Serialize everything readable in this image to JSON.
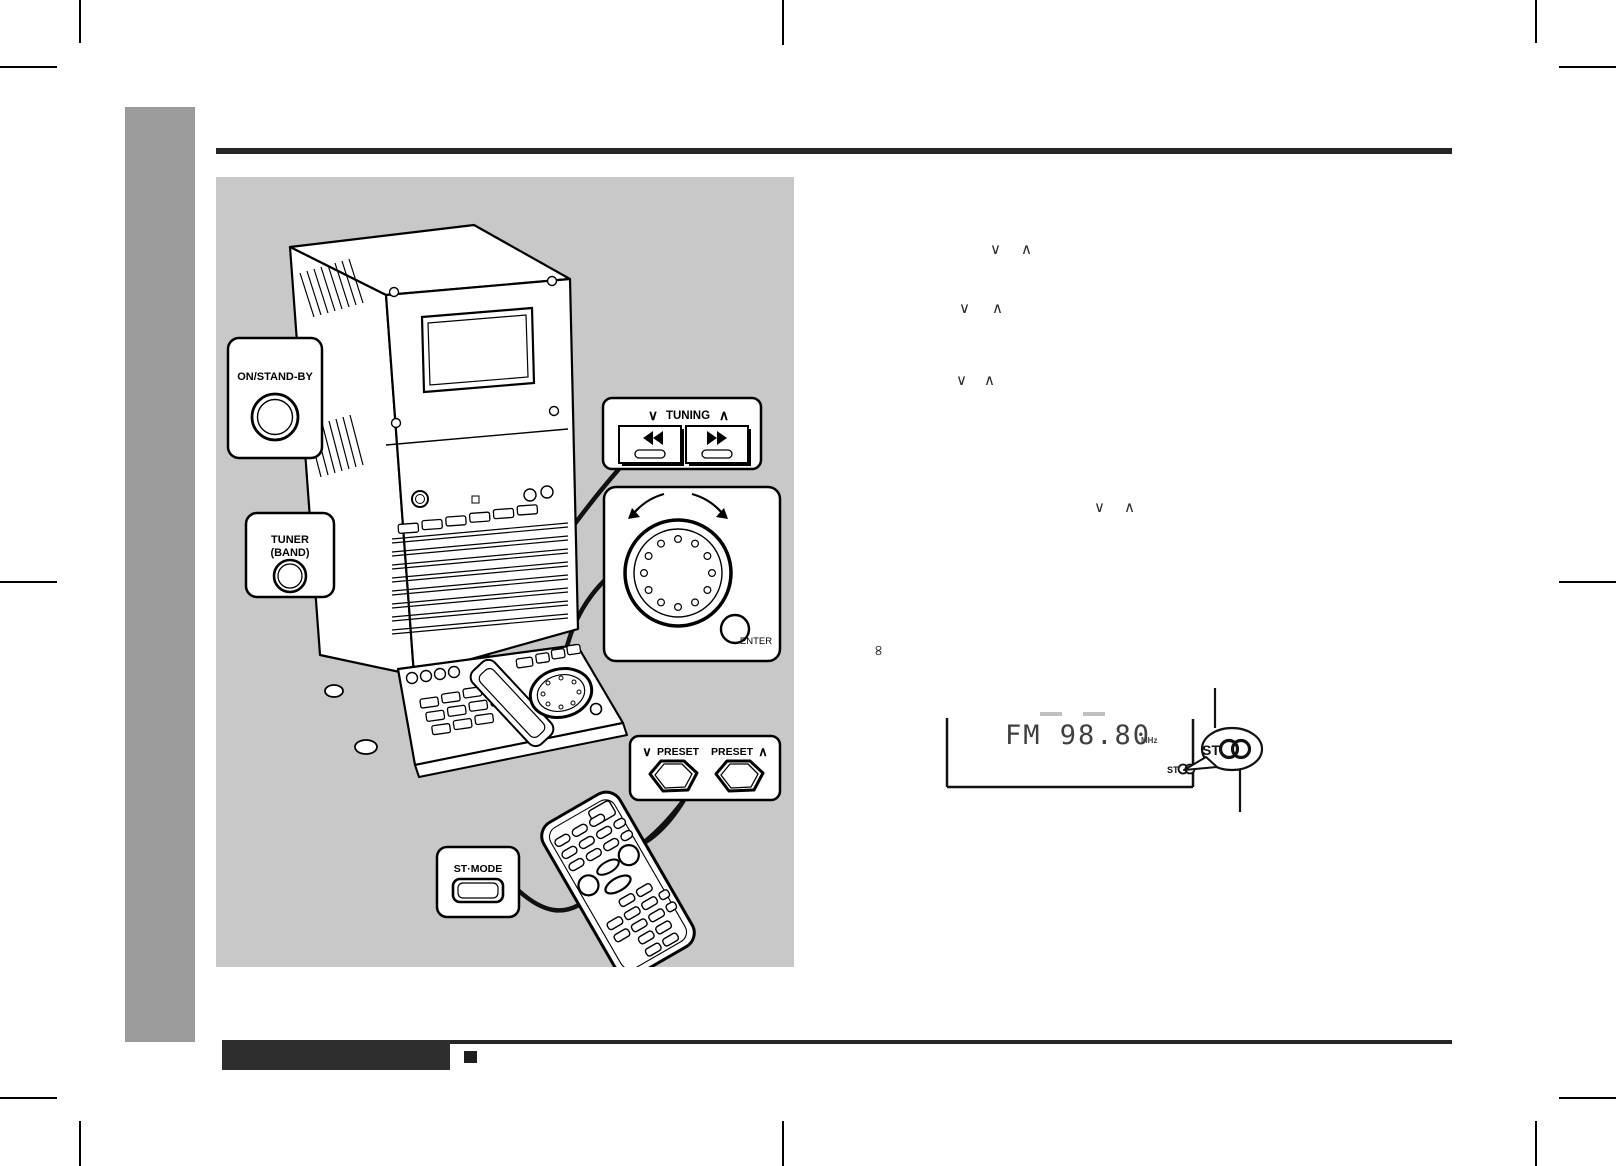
{
  "colors": {
    "panel_gray": "#c8c8c8",
    "sidebar_gray": "#9b9b9b",
    "rule_black": "#262626",
    "display_ink": "#3f3f3f"
  },
  "callouts": {
    "on_standby": {
      "label": "ON/STAND-BY"
    },
    "tuner": {
      "line1": "TUNER",
      "line2": "(BAND)"
    },
    "tuning": {
      "down": "∨",
      "label": "TUNING",
      "up": "∧"
    },
    "jog": {
      "enter": "ENTER"
    },
    "preset": {
      "down_symbol": "∨",
      "down_label": "PRESET",
      "up_label": "PRESET",
      "up_symbol": "∧"
    },
    "st_mode": {
      "label": "ST·MODE"
    }
  },
  "icons": {
    "tuning_rewind": "double-triangle-left",
    "tuning_forward": "double-triangle-right",
    "jog_left_arrow": "curved-arrow-counterclockwise",
    "jog_right_arrow": "curved-arrow-clockwise",
    "stereo_badge": "overlapping-circles"
  },
  "floating_symbols": {
    "pairs": [
      {
        "down": "∨",
        "up": "∧"
      },
      {
        "down": "∨",
        "up": "∧"
      },
      {
        "down": "∨",
        "up": "∧"
      },
      {
        "down": "∨",
        "up": "∧"
      }
    ],
    "rotated_infinity": "∞"
  },
  "display_figure": {
    "readout": "FM 98.80",
    "unit": "MHz",
    "st_indicator": "ST",
    "balloon_label": "ST"
  }
}
